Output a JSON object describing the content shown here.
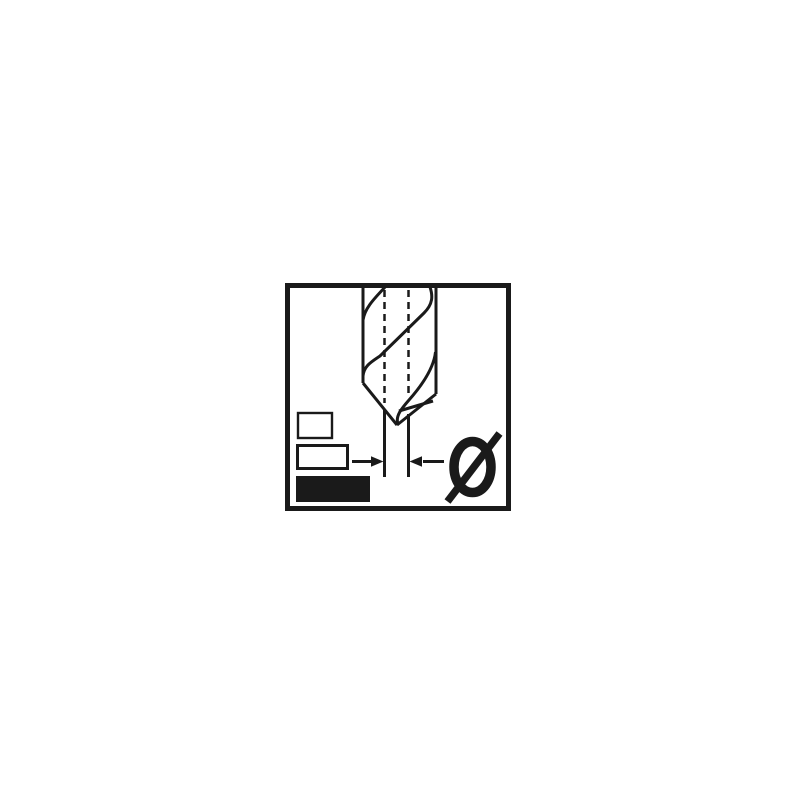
{
  "page": {
    "background_color": "#ffffff"
  },
  "pictogram": {
    "label": "drill-bit-diameter-pictogram",
    "ink_color": "#1a1a1a",
    "paper_color": "#ffffff",
    "frame": {
      "border_color": "#1a1a1a"
    },
    "diameter_symbol": "Ø",
    "drill_bit_label": "twist-drill-bit",
    "centerline_style": {
      "dash": "7 5"
    },
    "dimension": {
      "label": "drill-point-width-arrows"
    },
    "swatches": [
      {
        "label": "small-outlined-rectangle",
        "fill": "none"
      },
      {
        "label": "medium-outlined-rectangle",
        "fill": "none"
      },
      {
        "label": "large-filled-rectangle",
        "fill": "#1a1a1a"
      }
    ]
  }
}
